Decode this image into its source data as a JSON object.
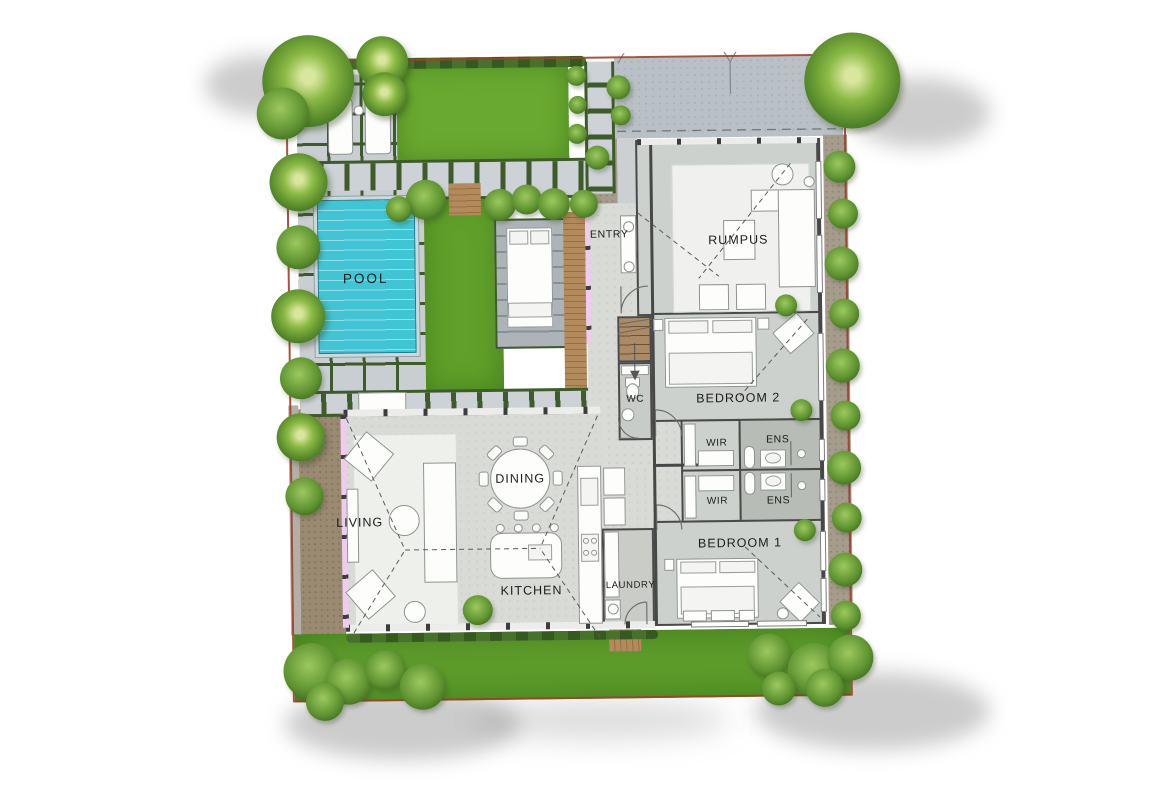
{
  "rooms": {
    "pool": {
      "label": "POOL"
    },
    "entry": {
      "label": "ENTRY"
    },
    "rumpus": {
      "label": "RUMPUS"
    },
    "wc": {
      "label": "WC"
    },
    "bedroom2": {
      "label": "BEDROOM 2"
    },
    "wir1": {
      "label": "WIR"
    },
    "wir2": {
      "label": "WIR"
    },
    "ens1": {
      "label": "ENS"
    },
    "ens2": {
      "label": "ENS"
    },
    "bedroom1": {
      "label": "BEDROOM 1"
    },
    "living": {
      "label": "LIVING"
    },
    "dining": {
      "label": "DINING"
    },
    "kitchen": {
      "label": "KITCHEN"
    },
    "laundry": {
      "label": "LAUNDRY"
    }
  },
  "colors": {
    "pool_water": "#41c4d4",
    "lawn": "#5f9e2c",
    "courtyard_grass": "#61a02a",
    "paver": "#cdd2d6",
    "paver_joint": "#3d5b2b",
    "timber_deck": "#ab8156",
    "interior_floor": "#d9dbd7",
    "wall": "#474747",
    "boundary_line": "#9e3f2a",
    "driveway": "#b9c0c6"
  }
}
